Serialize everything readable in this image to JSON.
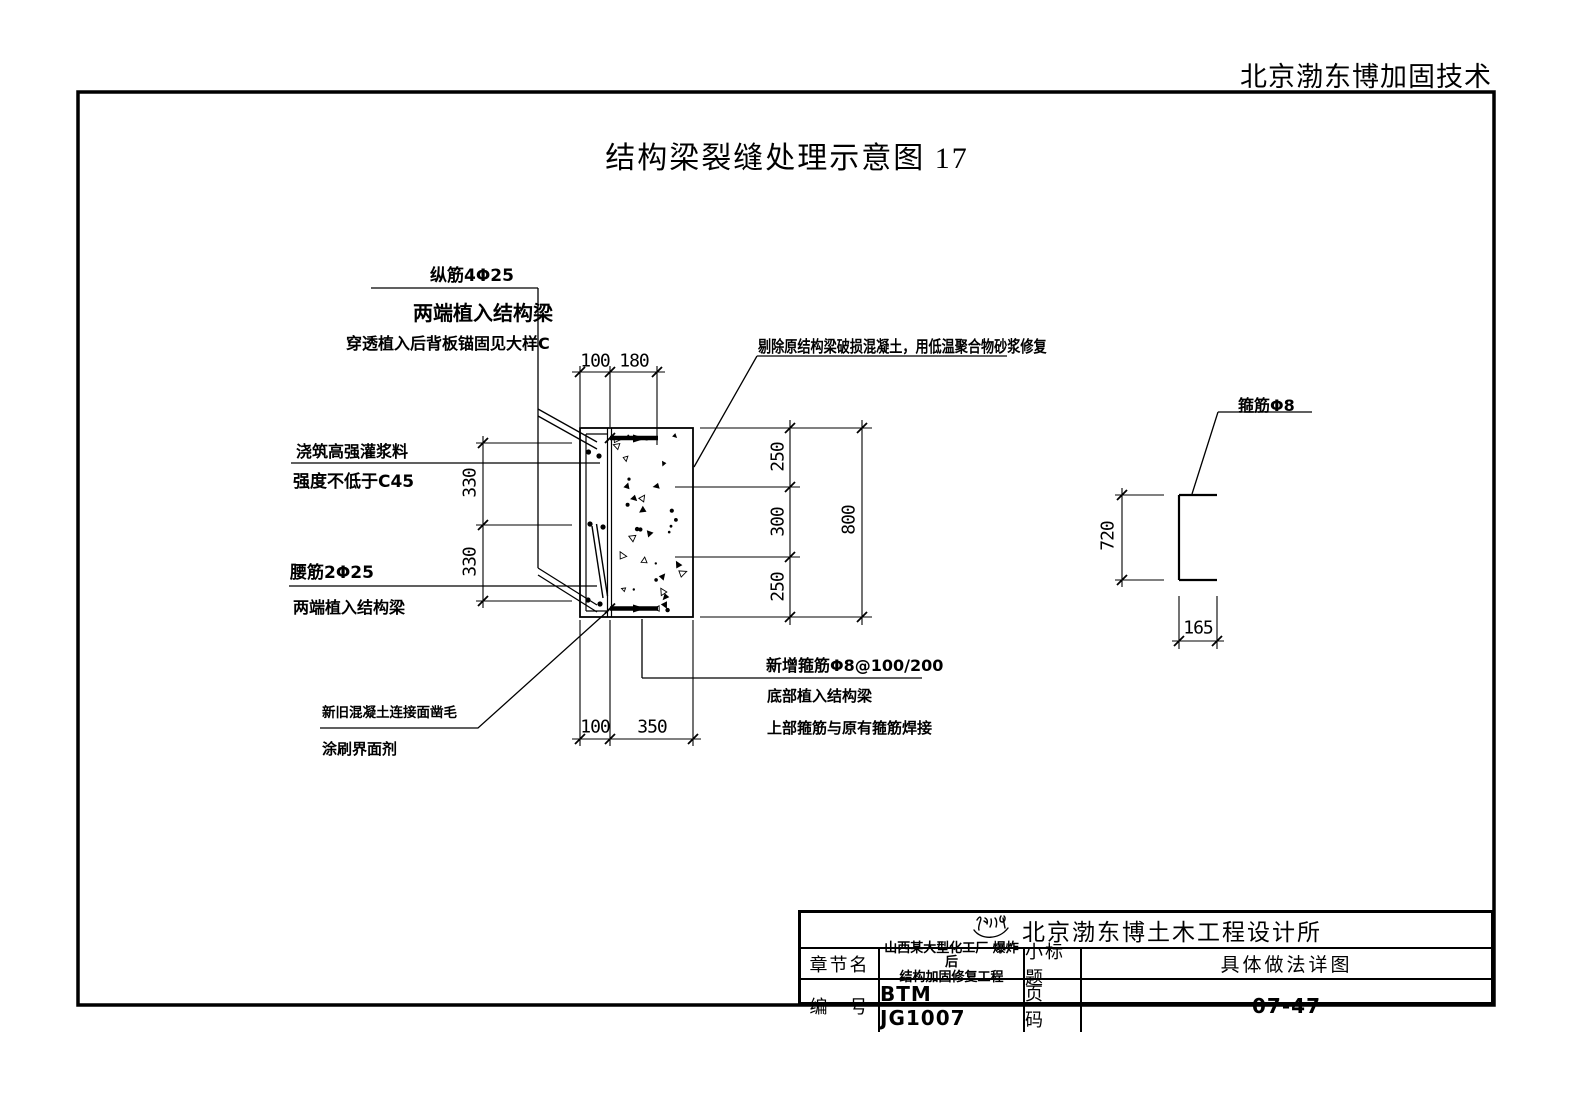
{
  "page": {
    "header_company": "北京渤东博加固技术",
    "drawing_title": "结构梁裂缝处理示意图  17"
  },
  "annotations": {
    "zongjin": {
      "l1": "纵筋4Φ25",
      "l2": "两端植入结构梁",
      "l3": "穿透植入后背板锚固见大样C"
    },
    "grout": {
      "l1": "浇筑高强灌浆料",
      "l2": "强度不低于C45"
    },
    "yaojin": {
      "l1": "腰筋2Φ25",
      "l2": "两端植入结构梁"
    },
    "chisel": {
      "l1": "新旧混凝土连接面凿毛",
      "l2": "涂刷界面剂"
    },
    "repair": {
      "l1": "剔除原结构梁破损混凝土，用低温聚合物砂浆修复"
    },
    "new_stirrup": {
      "l1": "新增箍筋Φ8@100/200",
      "l2": "底部植入结构梁",
      "l3": "上部箍筋与原有箍筋焊接"
    },
    "stirrup_detail": {
      "label": "箍筋Φ8"
    }
  },
  "dimensions": {
    "top_100": "100",
    "top_180": "180",
    "bottom_100": "100",
    "bottom_350": "350",
    "right_250a": "250",
    "right_300": "300",
    "right_250b": "250",
    "right_800": "800",
    "left_330a": "330",
    "left_330b": "330",
    "detail_720": "720",
    "detail_165": "165"
  },
  "title_block": {
    "company": "北京渤东博土木工程设计所",
    "chapter_label": "章节名",
    "chapter_value_line1": "山西某大型化工厂 爆炸后",
    "chapter_value_line2": "结构加固修复工程",
    "subtitle_label": "小标题",
    "subtitle_value": "具体做法详图",
    "number_label": "编　号",
    "number_value": "BTM JG1007",
    "page_label": "页　码",
    "page_value": "07-47"
  }
}
